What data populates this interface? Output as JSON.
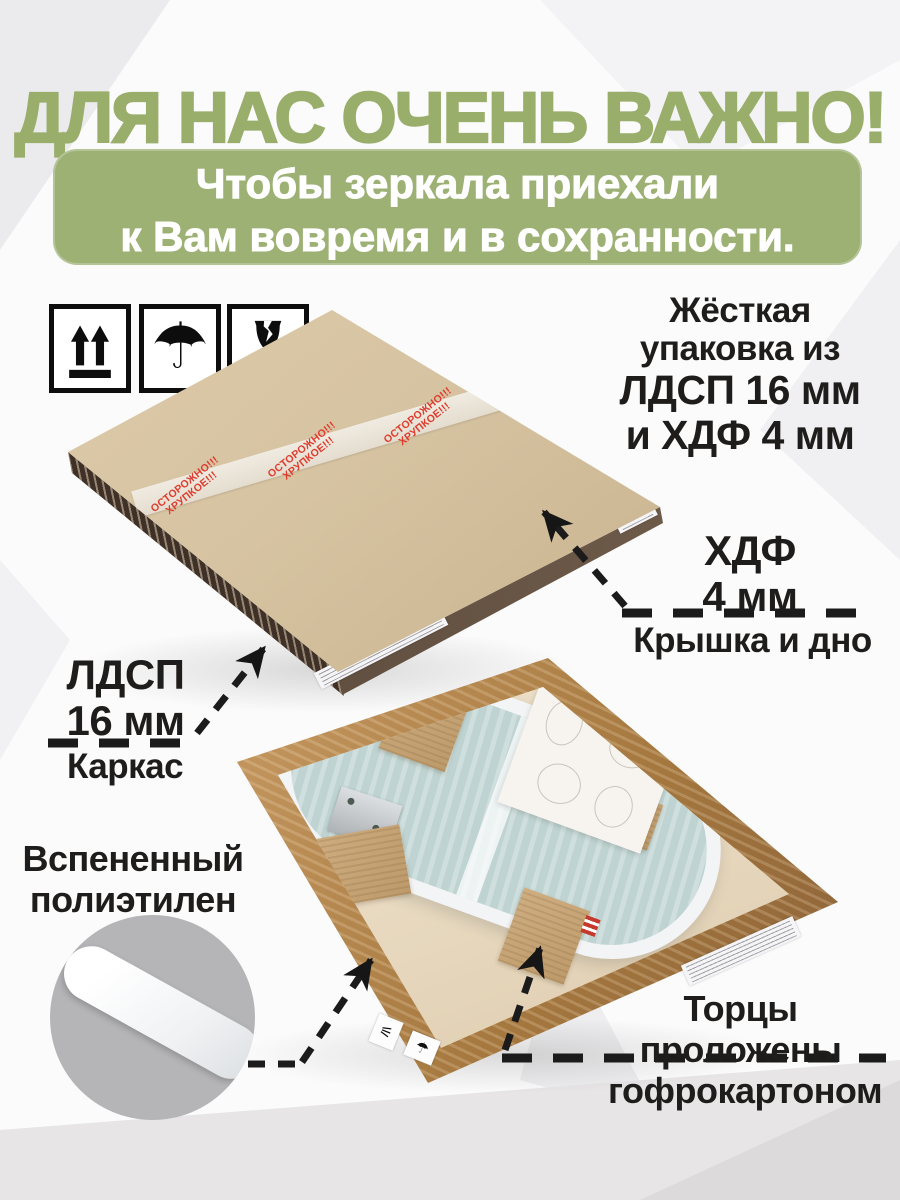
{
  "header": {
    "title": "ДЛЯ НАС ОЧЕНЬ ВАЖНО!",
    "banner_line1": "Чтобы зеркала приехали",
    "banner_line2": "к Вам вовремя и в сохранности."
  },
  "handling_icons": {
    "umbrella_glyph": "☂"
  },
  "photo1": {
    "tape_word1": "ОСТОРОЖНО!!!",
    "tape_word2": "ХРУПКОЕ!!!"
  },
  "annotations": {
    "rigid": {
      "line1": "Жёсткая",
      "line2": "упаковка из",
      "line3": "ЛДСП 16 мм",
      "line4": "и ХДФ 4 мм"
    },
    "hdf": {
      "material": "ХДФ",
      "thickness": "4 мм",
      "caption": "Крышка и дно"
    },
    "ldsp": {
      "material": "ЛДСП",
      "thickness": "16 мм",
      "caption": "Каркас"
    },
    "foam": {
      "line1": "Вспененный",
      "line2": "полиэтилен"
    },
    "edges": {
      "line1": "Торцы",
      "line2": "проложены",
      "line3": "гофрокартоном"
    }
  },
  "colors": {
    "accent_green": "#9aae6b",
    "banner_green": "#9db174",
    "text_dark": "#1e1d1b",
    "tape_red": "#df3b2d"
  }
}
